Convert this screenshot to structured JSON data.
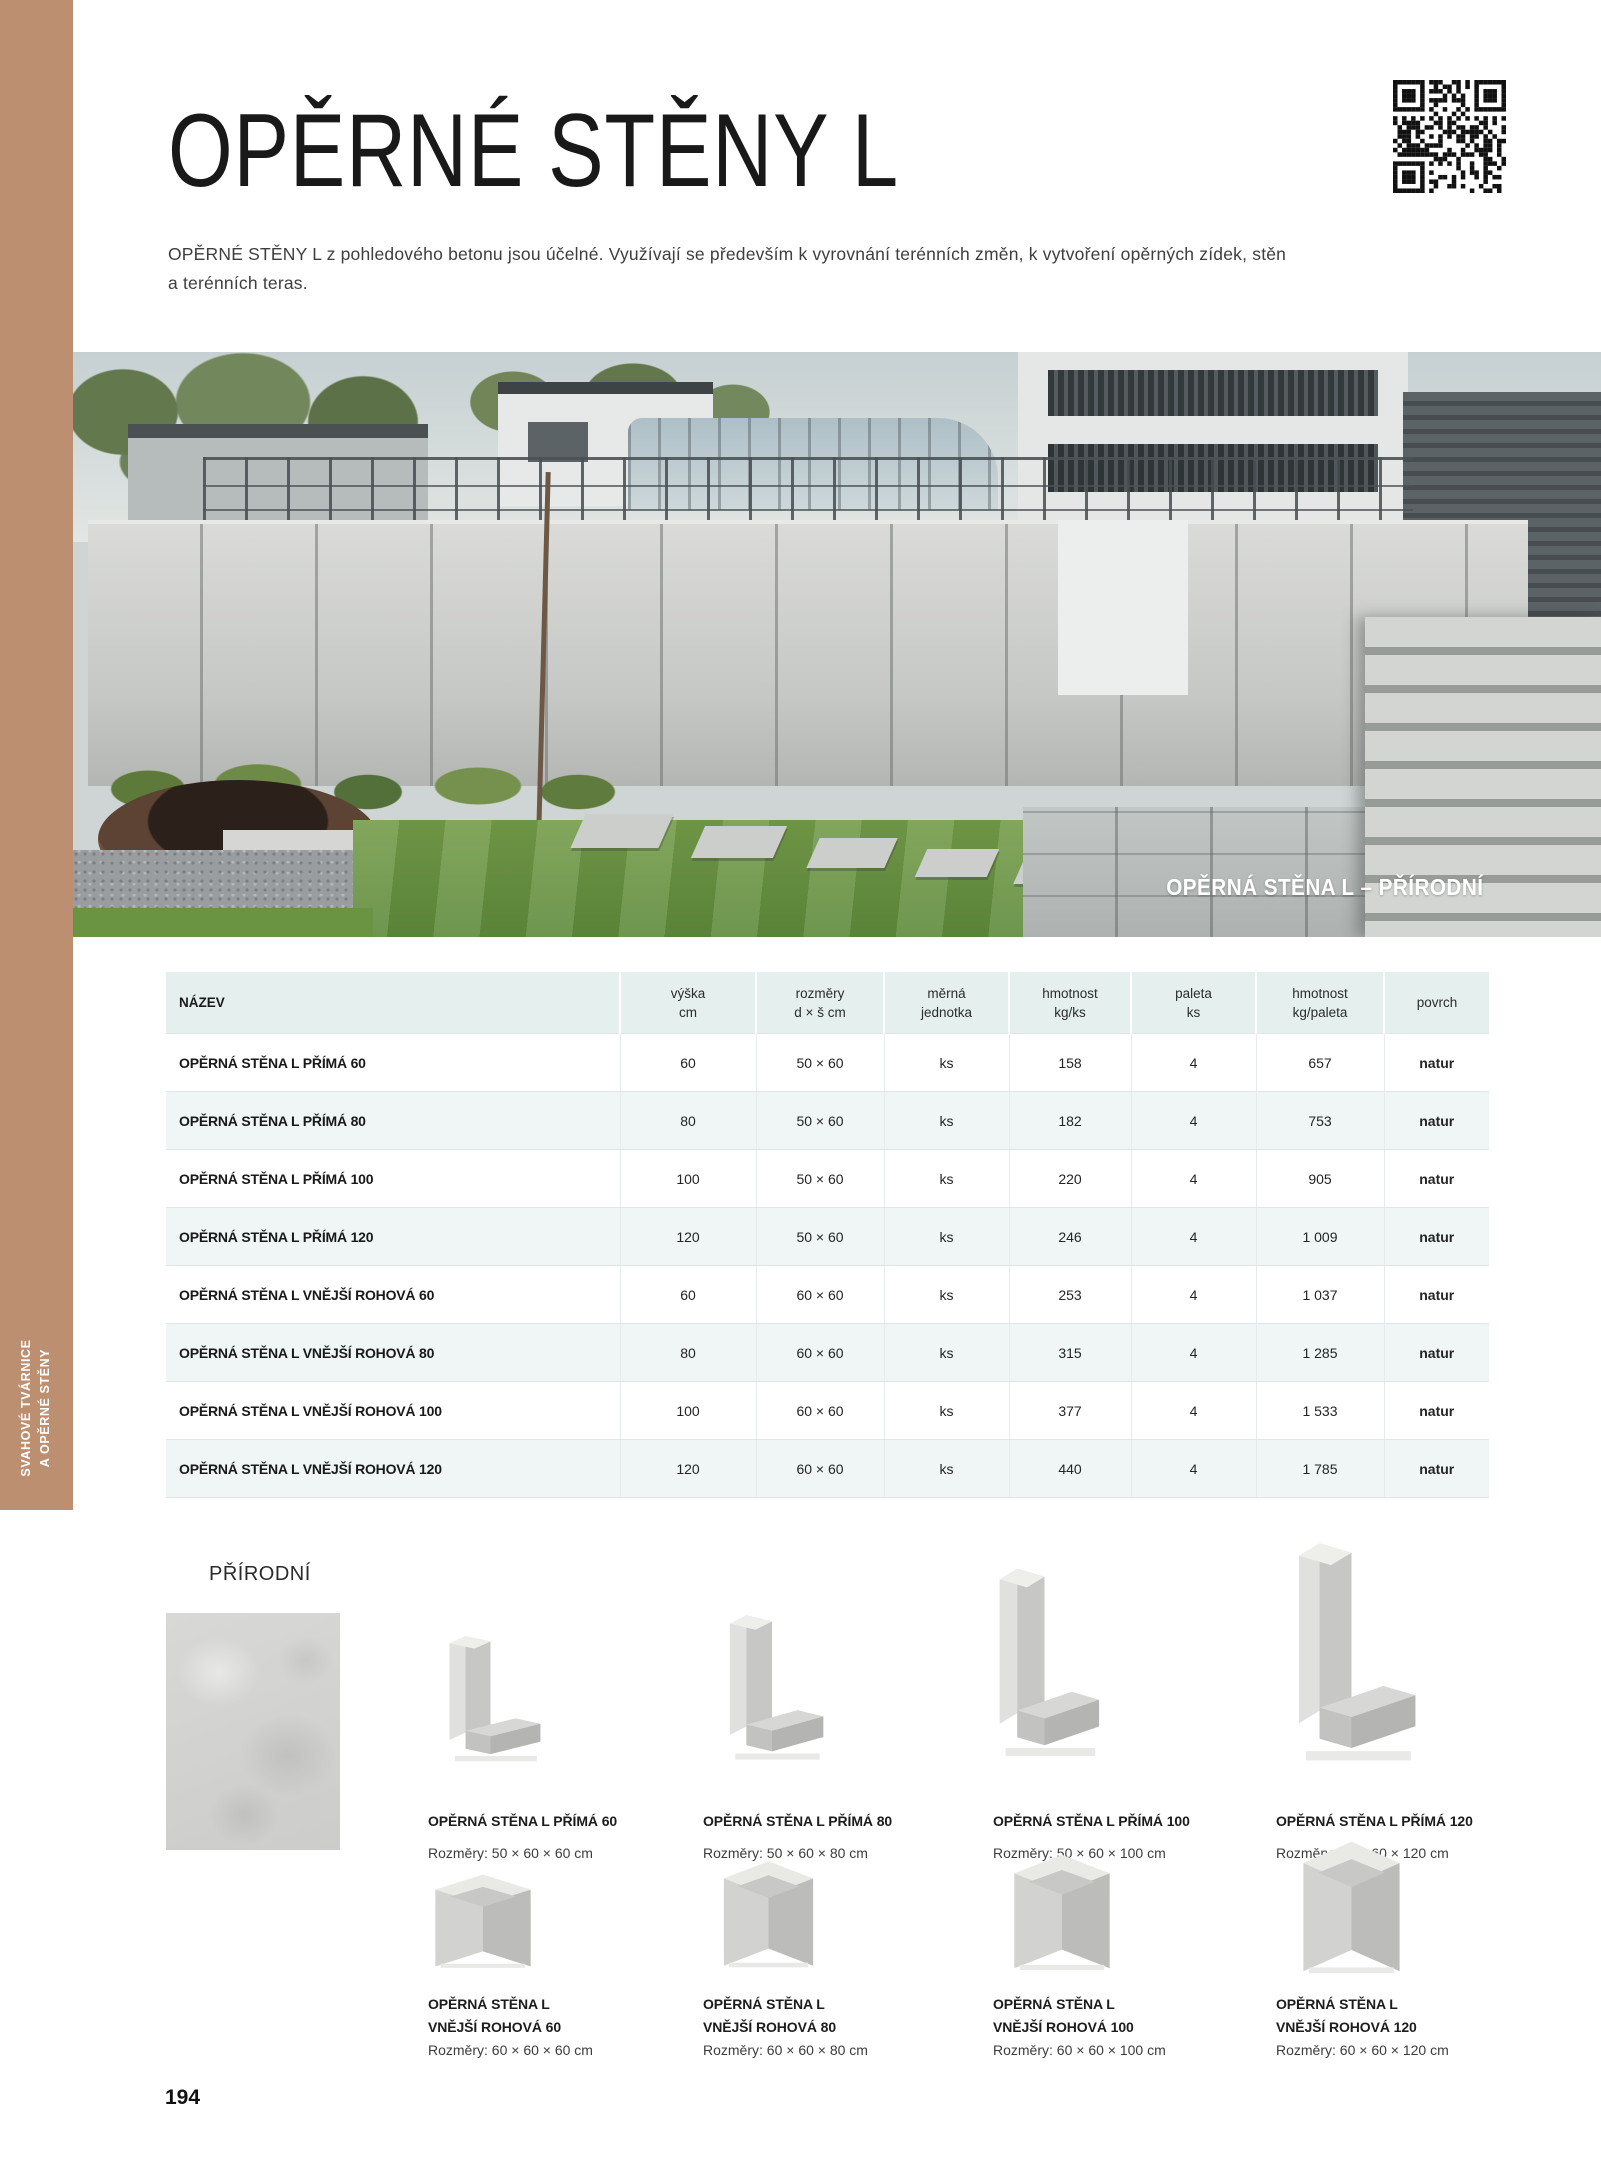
{
  "page": {
    "title": "OPĚRNÉ STĚNY L",
    "intro_line1": "OPĚRNÉ STĚNY L z pohledového betonu jsou účelné. Využívají se především k vyrovnání terénních změn, k vytvoření opěrných zídek, stěn",
    "intro_line2": "a terénních teras.",
    "page_number": "194",
    "accent_brown": "#bd8f71"
  },
  "sidebar": {
    "line1": "SVAHOVÉ TVÁRNICE",
    "line2": "A OPĚRNÉ STĚNY"
  },
  "photo": {
    "caption": "OPĚRNÁ STĚNA L – PŘÍRODNÍ"
  },
  "table": {
    "header_bg": "#e4efee",
    "alt_row_bg": "#eff6f5",
    "headers": {
      "nazev": "NÁZEV",
      "vyska_1": "výška",
      "vyska_2": "cm",
      "rozmery_1": "rozměry",
      "rozmery_2": "d × š cm",
      "merna_1": "měrná",
      "merna_2": "jednotka",
      "hmotnost_1": "hmotnost",
      "hmotnost_2": "kg/ks",
      "paleta_1": "paleta",
      "paleta_2": "ks",
      "hmotpal_1": "hmotnost",
      "hmotpal_2": "kg/paleta",
      "povrch": "povrch"
    },
    "rows": [
      {
        "name": "OPĚRNÁ STĚNA L PŘÍMÁ 60",
        "vyska": "60",
        "rozmery": "50 × 60",
        "jednotka": "ks",
        "kg_ks": "158",
        "paleta": "4",
        "kg_paleta": "657",
        "povrch": "natur"
      },
      {
        "name": "OPĚRNÁ STĚNA L PŘÍMÁ 80",
        "vyska": "80",
        "rozmery": "50 × 60",
        "jednotka": "ks",
        "kg_ks": "182",
        "paleta": "4",
        "kg_paleta": "753",
        "povrch": "natur"
      },
      {
        "name": "OPĚRNÁ STĚNA L PŘÍMÁ 100",
        "vyska": "100",
        "rozmery": "50 × 60",
        "jednotka": "ks",
        "kg_ks": "220",
        "paleta": "4",
        "kg_paleta": "905",
        "povrch": "natur"
      },
      {
        "name": "OPĚRNÁ STĚNA L PŘÍMÁ 120",
        "vyska": "120",
        "rozmery": "50 × 60",
        "jednotka": "ks",
        "kg_ks": "246",
        "paleta": "4",
        "kg_paleta": "1 009",
        "povrch": "natur"
      },
      {
        "name": "OPĚRNÁ STĚNA L VNĚJŠÍ ROHOVÁ 60",
        "vyska": "60",
        "rozmery": "60 × 60",
        "jednotka": "ks",
        "kg_ks": "253",
        "paleta": "4",
        "kg_paleta": "1 037",
        "povrch": "natur"
      },
      {
        "name": "OPĚRNÁ STĚNA L VNĚJŠÍ ROHOVÁ 80",
        "vyska": "80",
        "rozmery": "60 × 60",
        "jednotka": "ks",
        "kg_ks": "315",
        "paleta": "4",
        "kg_paleta": "1 285",
        "povrch": "natur"
      },
      {
        "name": "OPĚRNÁ STĚNA L VNĚJŠÍ ROHOVÁ 100",
        "vyska": "100",
        "rozmery": "60 × 60",
        "jednotka": "ks",
        "kg_ks": "377",
        "paleta": "4",
        "kg_paleta": "1 533",
        "povrch": "natur"
      },
      {
        "name": "OPĚRNÁ STĚNA L VNĚJŠÍ ROHOVÁ 120",
        "vyska": "120",
        "rozmery": "60 × 60",
        "jednotka": "ks",
        "kg_ks": "440",
        "paleta": "4",
        "kg_paleta": "1 785",
        "povrch": "natur"
      }
    ]
  },
  "surface": {
    "label": "PŘÍRODNÍ"
  },
  "products": {
    "row1": [
      {
        "name": "OPĚRNÁ STĚNA L PŘÍMÁ 60",
        "dims": "Rozměry: 50 × 60 × 60 cm"
      },
      {
        "name": "OPĚRNÁ STĚNA L PŘÍMÁ 80",
        "dims": "Rozměry: 50 × 60 × 80 cm"
      },
      {
        "name": "OPĚRNÁ STĚNA L PŘÍMÁ 100",
        "dims": "Rozměry: 50 × 60 × 100 cm"
      },
      {
        "name": "OPĚRNÁ STĚNA L PŘÍMÁ 120",
        "dims": "Rozměry: 50 × 60 × 120 cm"
      }
    ],
    "row2": [
      {
        "line1": "OPĚRNÁ STĚNA L",
        "line2": "VNĚJŠÍ ROHOVÁ 60",
        "dims": "Rozměry: 60 × 60 × 60 cm"
      },
      {
        "line1": "OPĚRNÁ STĚNA L",
        "line2": "VNĚJŠÍ ROHOVÁ 80",
        "dims": "Rozměry: 60 × 60 × 80 cm"
      },
      {
        "line1": "OPĚRNÁ STĚNA L",
        "line2": "VNĚJŠÍ ROHOVÁ 100",
        "dims": "Rozměry: 60 × 60 × 100 cm"
      },
      {
        "line1": "OPĚRNÁ STĚNA L",
        "line2": "VNĚJŠÍ ROHOVÁ 120",
        "dims": "Rozměry: 60 × 60 × 120 cm"
      }
    ]
  }
}
